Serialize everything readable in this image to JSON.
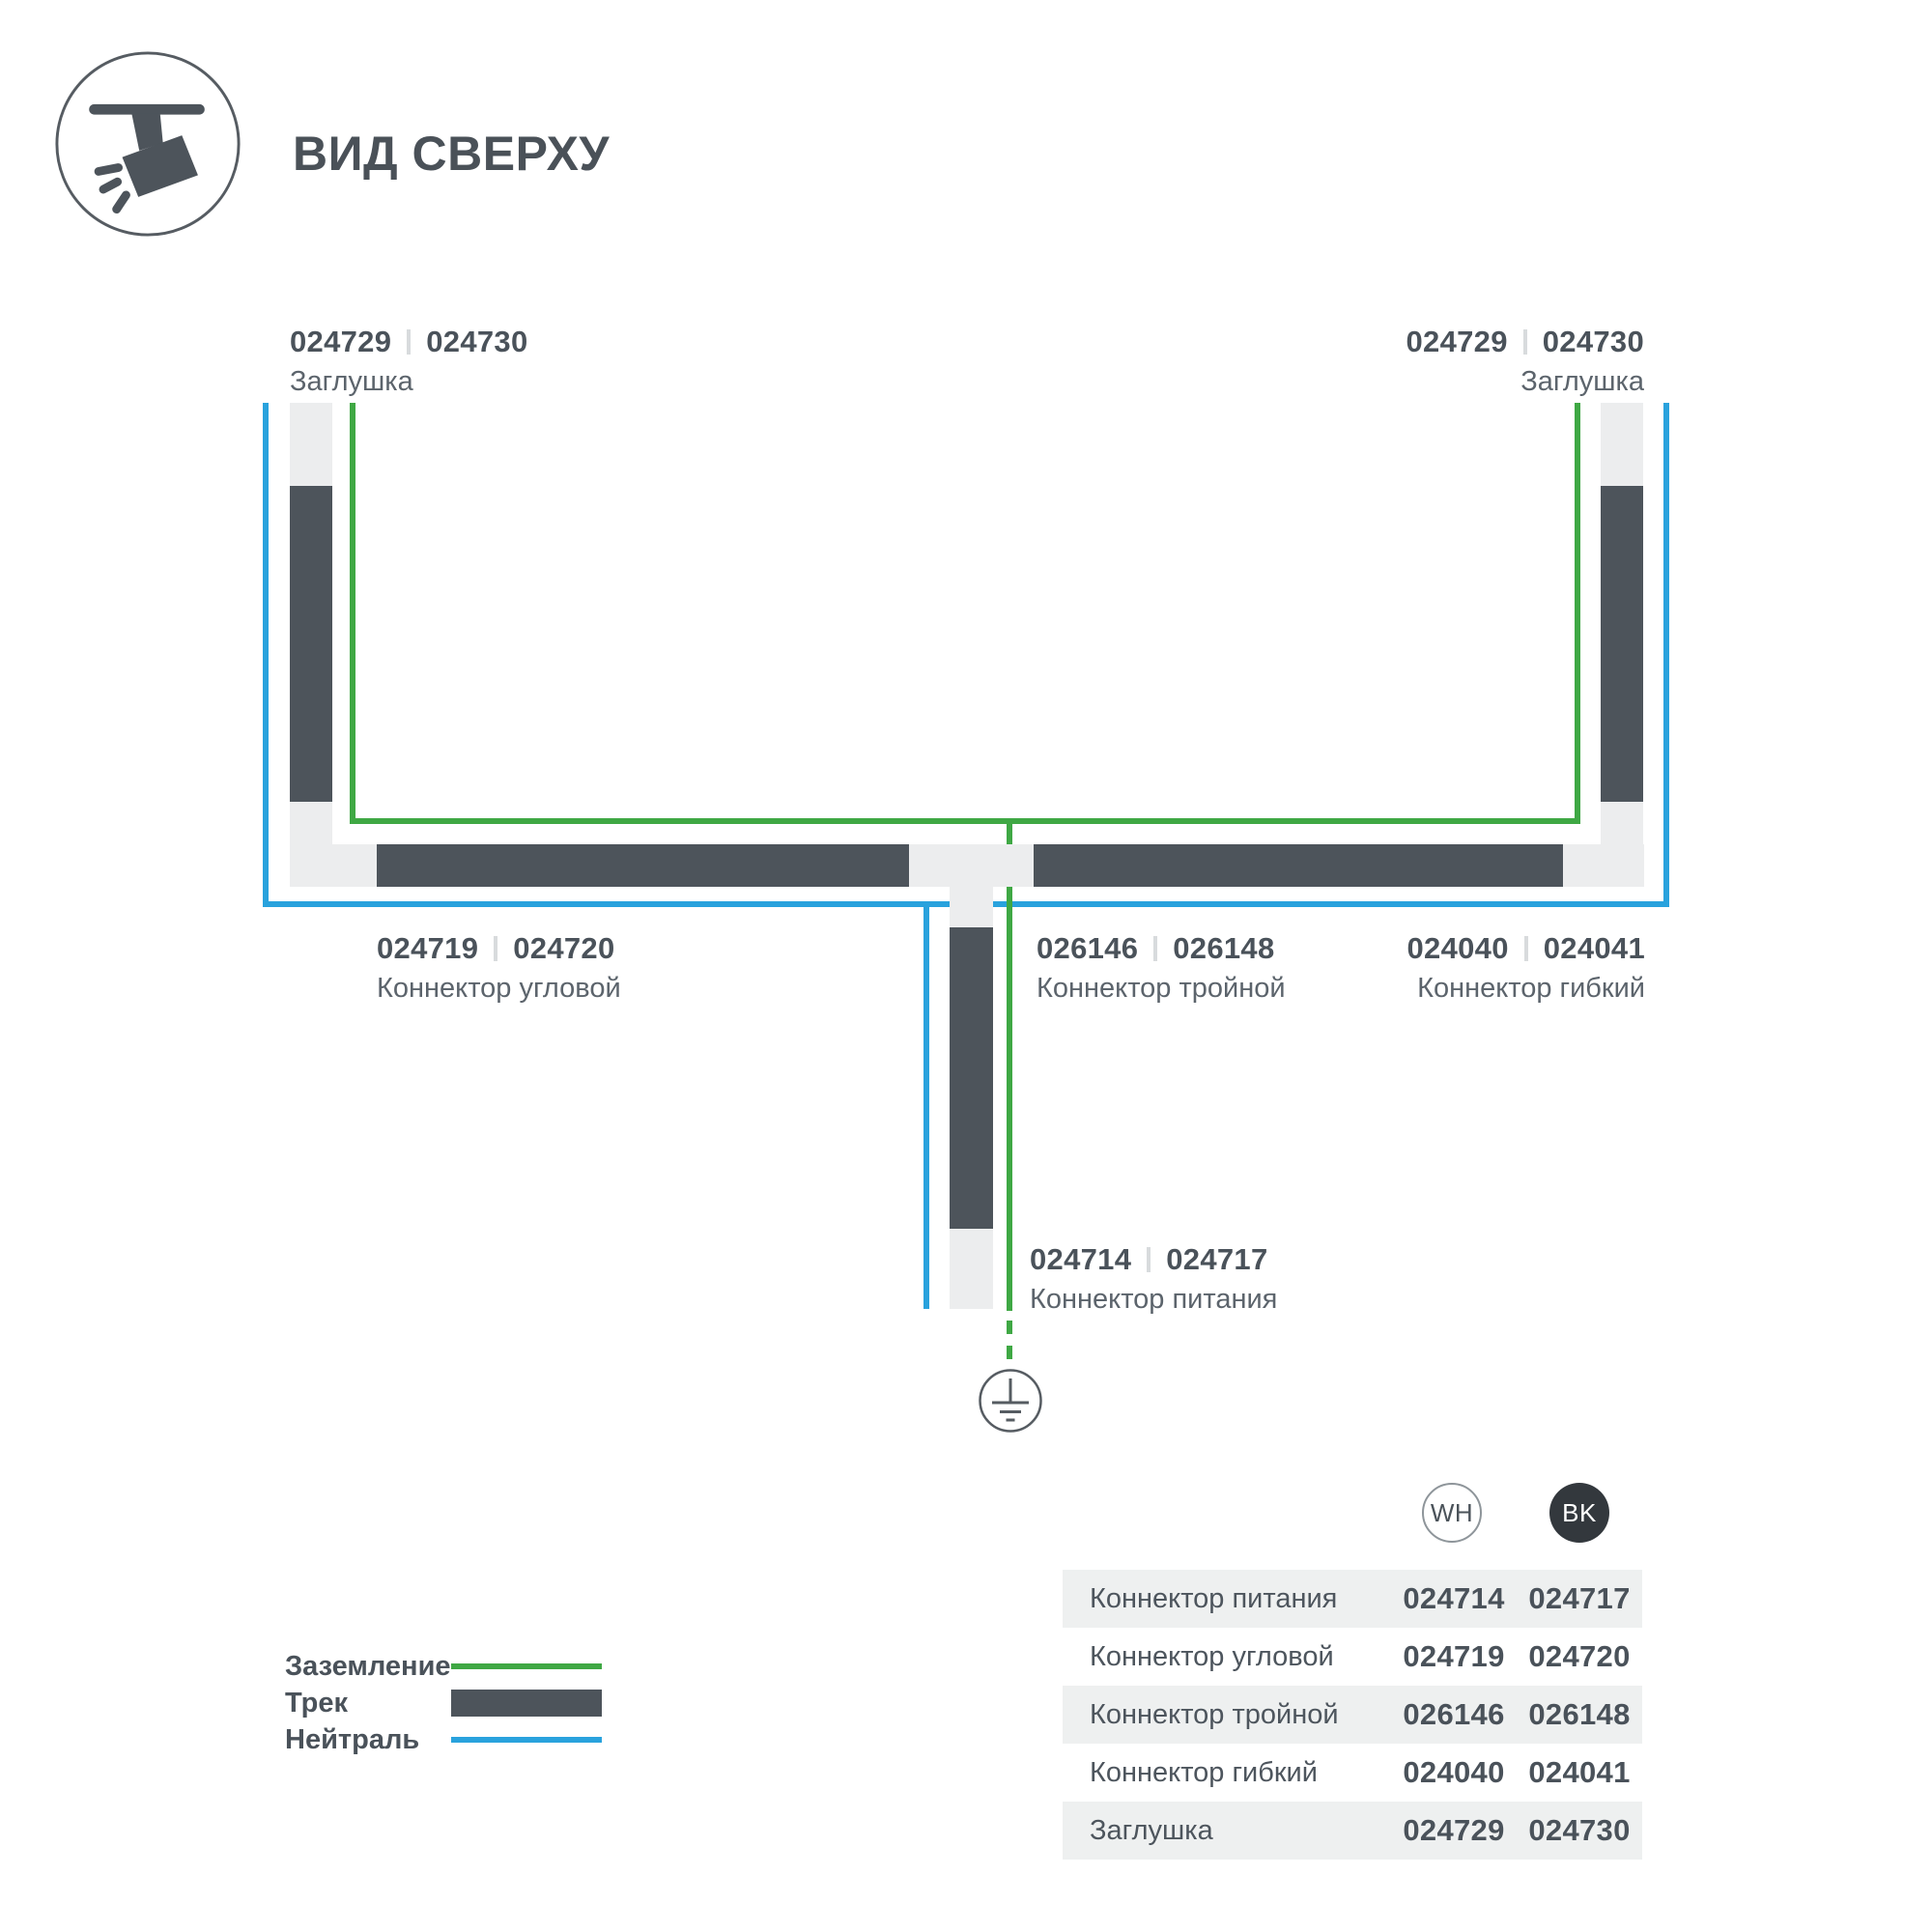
{
  "title": "ВИД СВЕРХУ",
  "icon": "track-spotlight-top-view",
  "colors": {
    "ground_green": "#3FA844",
    "neutral_blue": "#29A2DD",
    "track_dark": "#4D545B",
    "track_light": "#ECEDEE",
    "text_dark": "#4A525A",
    "text_mid": "#5C646C",
    "bk_badge": "#33383D",
    "row_shade": "#EEF0F0"
  },
  "diagram": {
    "cap_left": {
      "code_wh": "024729",
      "code_bk": "024730",
      "name": "Заглушка"
    },
    "cap_right": {
      "code_wh": "024729",
      "code_bk": "024730",
      "name": "Заглушка"
    },
    "corner": {
      "code_wh": "024719",
      "code_bk": "024720",
      "name": "Коннектор угловой"
    },
    "triple": {
      "code_wh": "026146",
      "code_bk": "026148",
      "name": "Коннектор тройной"
    },
    "flex": {
      "code_wh": "024040",
      "code_bk": "024041",
      "name": "Коннектор гибкий"
    },
    "power": {
      "code_wh": "024714",
      "code_bk": "024717",
      "name": "Коннектор питания"
    }
  },
  "legend": {
    "items": [
      {
        "label": "Заземление",
        "swatch": "green-line"
      },
      {
        "label": "Трек",
        "swatch": "dark-bar"
      },
      {
        "label": "Нейтраль",
        "swatch": "blue-line"
      }
    ]
  },
  "table": {
    "col_wh": "WH",
    "col_bk": "BK",
    "rows": [
      {
        "label": "Коннектор питания",
        "wh": "024714",
        "bk": "024717"
      },
      {
        "label": "Коннектор угловой",
        "wh": "024719",
        "bk": "024720"
      },
      {
        "label": "Коннектор тройной",
        "wh": "026146",
        "bk": "026148"
      },
      {
        "label": "Коннектор гибкий",
        "wh": "024040",
        "bk": "024041"
      },
      {
        "label": "Заглушка",
        "wh": "024729",
        "bk": "024730"
      }
    ]
  }
}
